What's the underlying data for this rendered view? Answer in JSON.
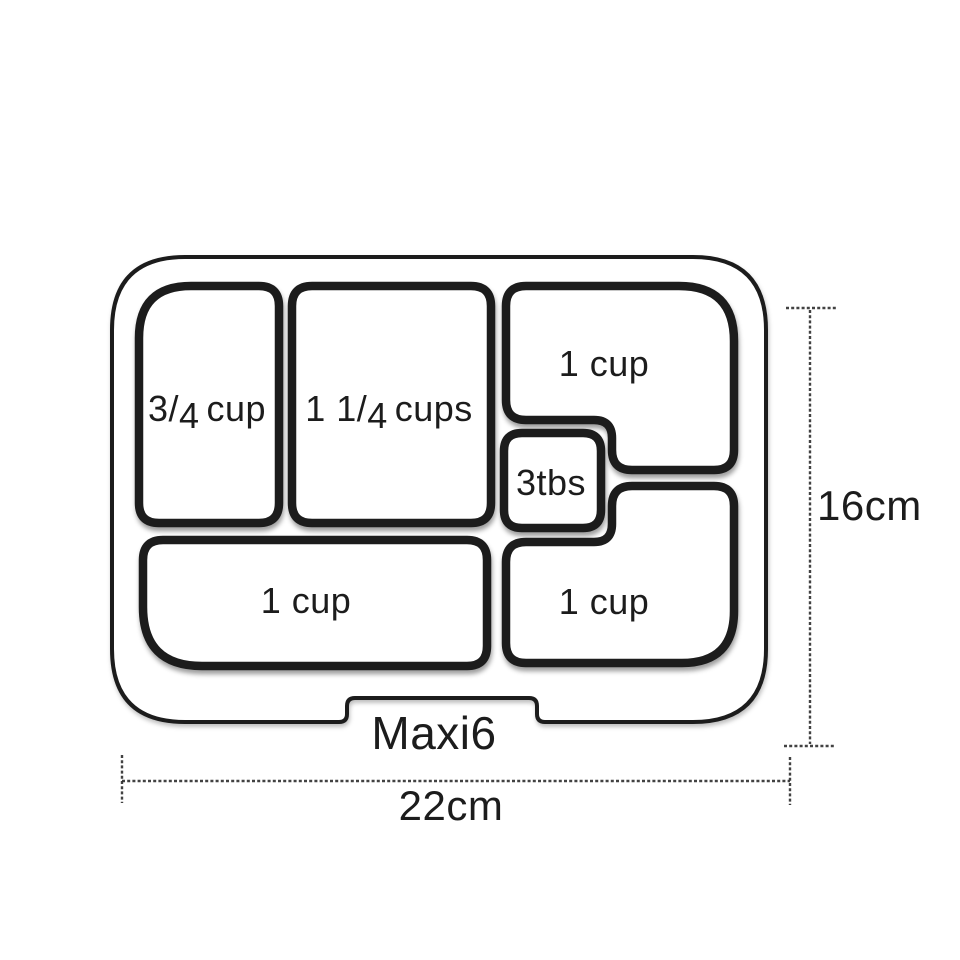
{
  "colors": {
    "line": "#1c1c1c",
    "dimension_line": "#2e2e2e",
    "background": "#ffffff"
  },
  "product": {
    "name": "Maxi6"
  },
  "dimensions": {
    "height": "16cm",
    "width": "22cm"
  },
  "compartments": [
    {
      "position": "top-left",
      "capacity": "3/4 cup",
      "parts": {
        "a": "3/",
        "b": "4",
        "c": "cup"
      }
    },
    {
      "position": "top-center",
      "capacity": "1 1/4 cups",
      "parts": {
        "a": "1 1/",
        "b": "4",
        "c": "cups"
      }
    },
    {
      "position": "top-right",
      "capacity": "1 cup"
    },
    {
      "position": "middle-small",
      "capacity": "3tbs"
    },
    {
      "position": "bottom-right",
      "capacity": "1 cup"
    },
    {
      "position": "bottom-left",
      "capacity": "1 cup"
    }
  ]
}
